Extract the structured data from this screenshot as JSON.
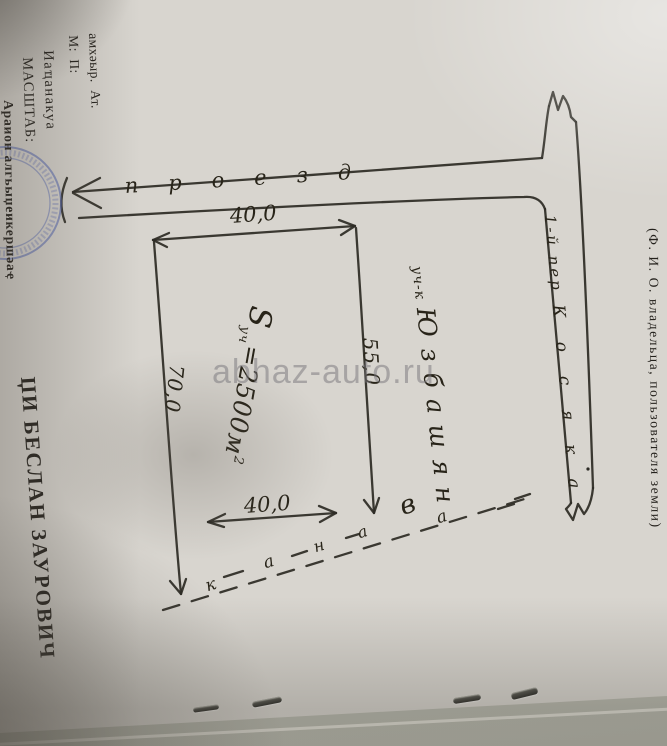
{
  "photo": {
    "watermark": "abhaz-auto.ru",
    "paper_color": "#d8d5cf",
    "ink_color": "#2c2a24",
    "stamp_color": "#4f63b5"
  },
  "form": {
    "header_lines": [
      "амхәыр.  Ат.",
      "М:  П:",
      "Иаҵанакуа",
      "МАСШТАБ:",
      "Араион алгьыџеикершәаҿ"
    ],
    "owner_name": "ЏИ БЕСЛАН ЗАУРОВИЧ",
    "owner_caption": "(Ф. И. О. владельца, пользователя земли)"
  },
  "plan": {
    "road_label": "проезд",
    "street_label": "1-й пер",
    "street_name": "Косяка",
    "dim_top": "40,0",
    "dim_inner": "40,0",
    "dim_right": "55,0",
    "dim_left": "70,0",
    "area": {
      "symbol": "S",
      "subscript": "уч",
      "equals_value": "=2500м",
      "superscript": "2"
    },
    "neighbor_prefix": "уч-к",
    "neighbor_name": "Юзбашян",
    "ditch_letters": [
      "к",
      "а",
      "н",
      "а",
      "в",
      "а"
    ]
  }
}
